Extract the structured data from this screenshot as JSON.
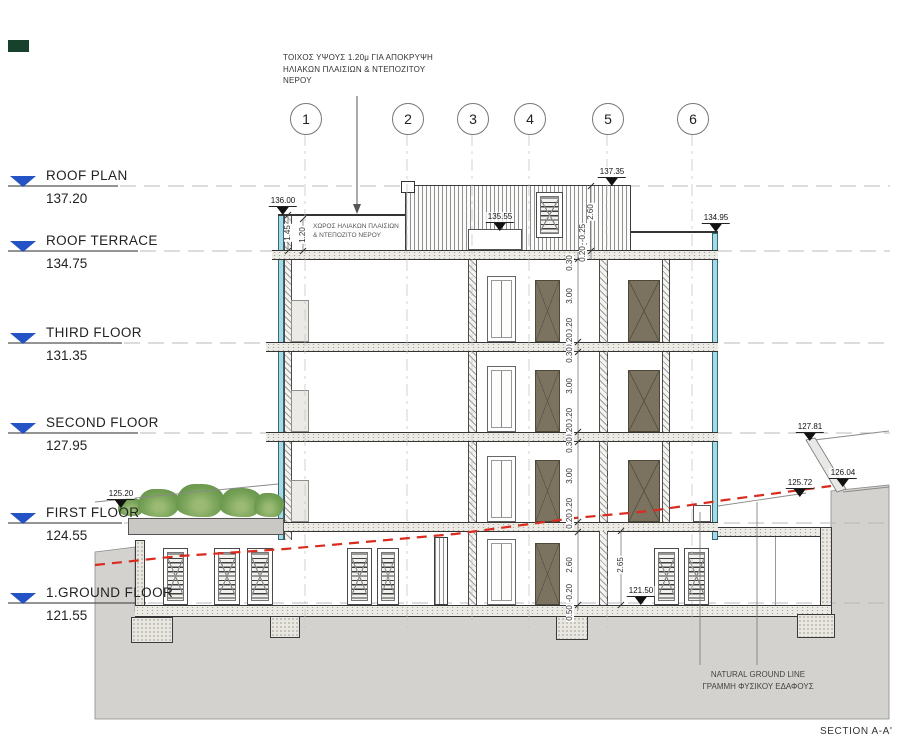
{
  "title": "SECTION A-A'",
  "annotations": {
    "wall_note": "ΤΟΙΧΟΣ ΥΨΟΥΣ 1.20μ ΓΙΑ ΑΠΟΚΡΥΨΗ ΗΛΙΑΚΩΝ ΠΛΑΙΣΙΩΝ & ΝΤΕΠΟΖΙΤΟΥ ΝΕΡΟΥ",
    "terrace_note": "ΧΩΡΟΣ ΗΛΙΑΚΩΝ ΠΛΑΙΣΙΩΝ & ΝΤΕΠΟΖΙΤΟ ΝΕΡΟΥ",
    "ground_line_en": "NATURAL GROUND LINE",
    "ground_line_gr": "ΓΡΑΜΜΗ ΦΥΣΙΚΟΥ ΕΔΑΦΟΥΣ"
  },
  "grid": [
    "1",
    "2",
    "3",
    "4",
    "5",
    "6"
  ],
  "levels": [
    {
      "name": "ROOF PLAN",
      "elevation": "137.20"
    },
    {
      "name": "ROOF TERRACE",
      "elevation": "134.75"
    },
    {
      "name": "THIRD FLOOR",
      "elevation": "131.35"
    },
    {
      "name": "SECOND FLOOR",
      "elevation": "127.95"
    },
    {
      "name": "FIRST FLOOR",
      "elevation": "124.55"
    },
    {
      "name": "1.GROUND FLOOR",
      "elevation": "121.55"
    }
  ],
  "spots": {
    "parapet_left": "136.00",
    "bulkhead_top": "137.35",
    "terrace_mid": "135.55",
    "parapet_right": "134.95",
    "planter_top": "125.20",
    "terrain_high": "127.81",
    "terrain_mid": "126.04",
    "terrain_low": "125.72",
    "grade": "121.50"
  },
  "dims": {
    "parapet_total": "1.45",
    "parapet_wall": "1.20",
    "bulkhead_height": "2.60",
    "bulkhead_parapet": "-0.25",
    "slab_020": "0.20",
    "slab_030": "0.30",
    "floor_clear": "3.00",
    "floor_drop": "-0.20",
    "ground_clear": "2.60",
    "footing": "0.50",
    "ground_inner": "2.65"
  },
  "colors": {
    "level_marker_blue": "#2353c4",
    "wall_cyan": "#a8d8e4",
    "door_olive": "#7b7260",
    "ground_line_red": "#d92b1f",
    "plant_green": "#75a156",
    "ground_gray": "#d3d2cf"
  }
}
